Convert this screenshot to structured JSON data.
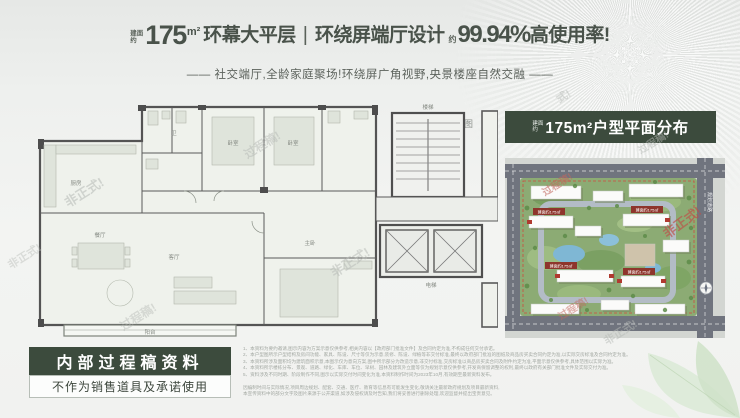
{
  "header": {
    "area_prefix_top": "建面",
    "area_prefix_bottom": "约",
    "area_value": "175",
    "area_unit": "m²",
    "title_left": "环幕大平层",
    "divider": "|",
    "title_mid": "环绕屏端厅设计",
    "rate_prefix": "约",
    "rate_value": "99.94%",
    "rate_suffix": "高使用率!",
    "subtitle": "——  社交端厅,全龄家庭聚场!环绕屏广角视野,央景楼座自然交融  ——"
  },
  "floorplan": {
    "caption": "创意改造图",
    "labels": {
      "living": "客厅",
      "dining": "餐厅",
      "kitchen": "厨房",
      "bedroom1": "卧室",
      "bedroom2": "卧室",
      "master": "主卧",
      "bath": "卫",
      "balcony": "阳台",
      "stairs": "楼梯",
      "elevator": "电梯"
    }
  },
  "siteplan": {
    "title_prefix_top": "建面",
    "title_prefix_bottom": "约",
    "title": "175m²户型平面分布",
    "unit_tag": "建面约175㎡",
    "road_label": "规划道路"
  },
  "stamp": {
    "title": "内部过程稿资料",
    "subtitle": "不作为销售道具及承诺使用"
  },
  "watermarks": [
    {
      "text": "非正式!",
      "x": 62,
      "y": 182,
      "rot": -32,
      "size": 13,
      "color": "#b6bab6",
      "opacity": 0.55
    },
    {
      "text": "过程稿!",
      "x": 242,
      "y": 136,
      "rot": -32,
      "size": 12,
      "color": "#b6bab6",
      "opacity": 0.5
    },
    {
      "text": "非正式!",
      "x": 328,
      "y": 252,
      "rot": -32,
      "size": 13,
      "color": "#b6bab6",
      "opacity": 0.5
    },
    {
      "text": "过程稿!",
      "x": 118,
      "y": 308,
      "rot": -32,
      "size": 12,
      "color": "#b6bab6",
      "opacity": 0.45
    },
    {
      "text": "非正式!",
      "x": 6,
      "y": 248,
      "rot": -32,
      "size": 11,
      "color": "#c0c4c0",
      "opacity": 0.5
    },
    {
      "text": "式!",
      "x": 556,
      "y": 88,
      "rot": -32,
      "size": 11,
      "color": "#b6bab6",
      "opacity": 0.5
    },
    {
      "text": "过程稿!",
      "x": 540,
      "y": 176,
      "rot": -32,
      "size": 10,
      "color": "#c2675e",
      "opacity": 0.6
    },
    {
      "text": "非正式!",
      "x": 660,
      "y": 212,
      "rot": -36,
      "size": 13,
      "color": "#bf4f48",
      "opacity": 0.65
    },
    {
      "text": "过程稿!",
      "x": 556,
      "y": 300,
      "rot": -32,
      "size": 10,
      "color": "#c2675e",
      "opacity": 0.5
    },
    {
      "text": "非正式!",
      "x": 602,
      "y": 324,
      "rot": -32,
      "size": 11,
      "color": "#b6bab6",
      "opacity": 0.5
    },
    {
      "text": "过程稿!",
      "x": 636,
      "y": 134,
      "rot": -32,
      "size": 10,
      "color": "#b6bab6",
      "opacity": 0.5
    }
  ],
  "disclaimer": {
    "lines": [
      "1、本资料为要约邀请,图示内容为方案示意仅供参考,相关内容以【政府部门批准文件】及合同约定为准,不构成任何交付承诺。",
      "2、本户型图所示户型结构及房间功能、家具、陈设、尺寸等仅为示意,装修、陈设、绿植等非交付标准,最终以政府部门批准的图纸及商品房买卖合同约定为准,以实际交房标准及合同约定为准。",
      "3、本资料所涉及面积均为建筑面积示意,本图示仅为意向方案,图中所示部分为改造示意,非交付标准,交房标准以商品房买卖合同及附件约定为准,平面示意仅供参考,具体范围以实际为准。",
      "4、本资料所示楼栋分布、景观、道路、绿化、车库、车位、早树、园林及建筑外立面等仅为规划示意仅供参考,开发商保留调整的权利,最终以政府有关部门批准文件及实际交付为准。",
      "5、资料涉及不同时期、阶段制作不同,图示以实际交付时间变化为准,本资料制作时间为2023年10月,有效期至最新资料发布。"
    ],
    "footer_lines": [
      "因编制时间与实际情况,项目周边规划、配套、交通、医疗、教育等信息有可能发生变化,敬请关注最新政府规划及项目最新资料,",
      "本宣传资料中的部分文字及图片来源于公开渠道,如涉及侵权请及时告知,我们将妥善进行删除处理,欢迎监督并提出宝贵意见。"
    ]
  }
}
